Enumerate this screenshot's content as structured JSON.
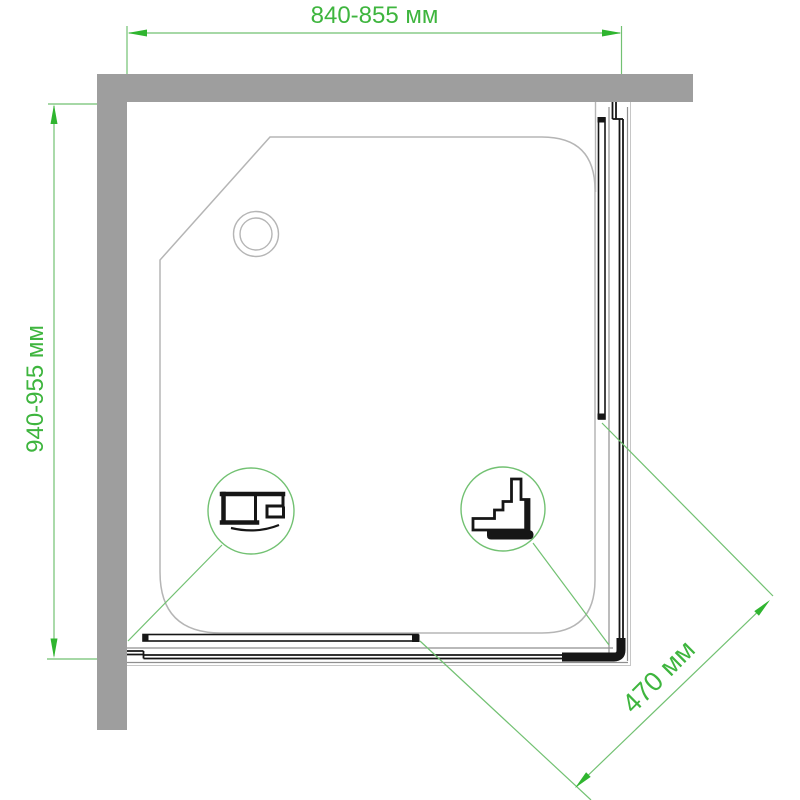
{
  "dimensions": {
    "top": {
      "label": "840-855 мм"
    },
    "left": {
      "label": "940-955 мм"
    },
    "diagonal": {
      "label": "470 мм"
    }
  },
  "icons": {
    "drain": "drain-concentric-circles",
    "detail_left": "bottom-rail-profile-section",
    "detail_right": "corner-step-profile-section"
  },
  "colors": {
    "dimension_text": "#3eb53e",
    "dimension_line": "#72c172",
    "dimension_arrow": "#2fb52f",
    "wall": "#9e9e9e",
    "tray_outline": "#b5b5b5",
    "profile": "#161616",
    "rail_gray": "#8f8f8f",
    "boundary_faint": "#c6c6c6"
  }
}
